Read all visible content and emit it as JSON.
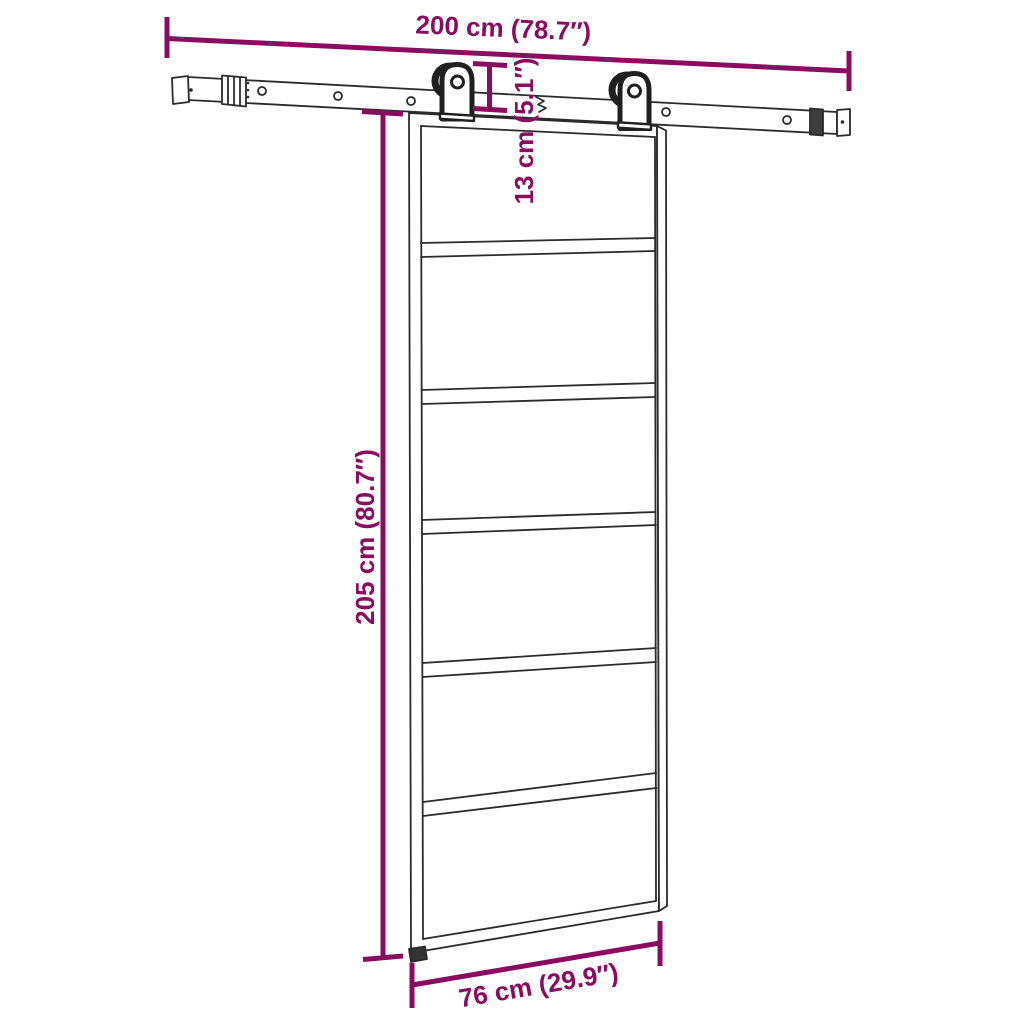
{
  "diagram": {
    "subject": "sliding-door-with-hardware-kit-dimensions",
    "colors": {
      "dimension": "#8B0B60",
      "line": "#2B2B2B",
      "hardware": "#1F1F1F",
      "background": "#FFFFFF"
    },
    "dimensions": {
      "rail_width": {
        "label": "200 cm (78.7″)",
        "value_cm": 200,
        "value_in": 78.7
      },
      "hanger_drop": {
        "label": "13 cm (5.1″)",
        "value_cm": 13,
        "value_in": 5.1
      },
      "door_height": {
        "label": "205 cm (80.7″)",
        "value_cm": 205,
        "value_in": 80.7
      },
      "door_width": {
        "label": "76 cm (29.9″)",
        "value_cm": 76,
        "value_in": 29.9
      }
    },
    "door": {
      "panel_count": 6
    }
  }
}
